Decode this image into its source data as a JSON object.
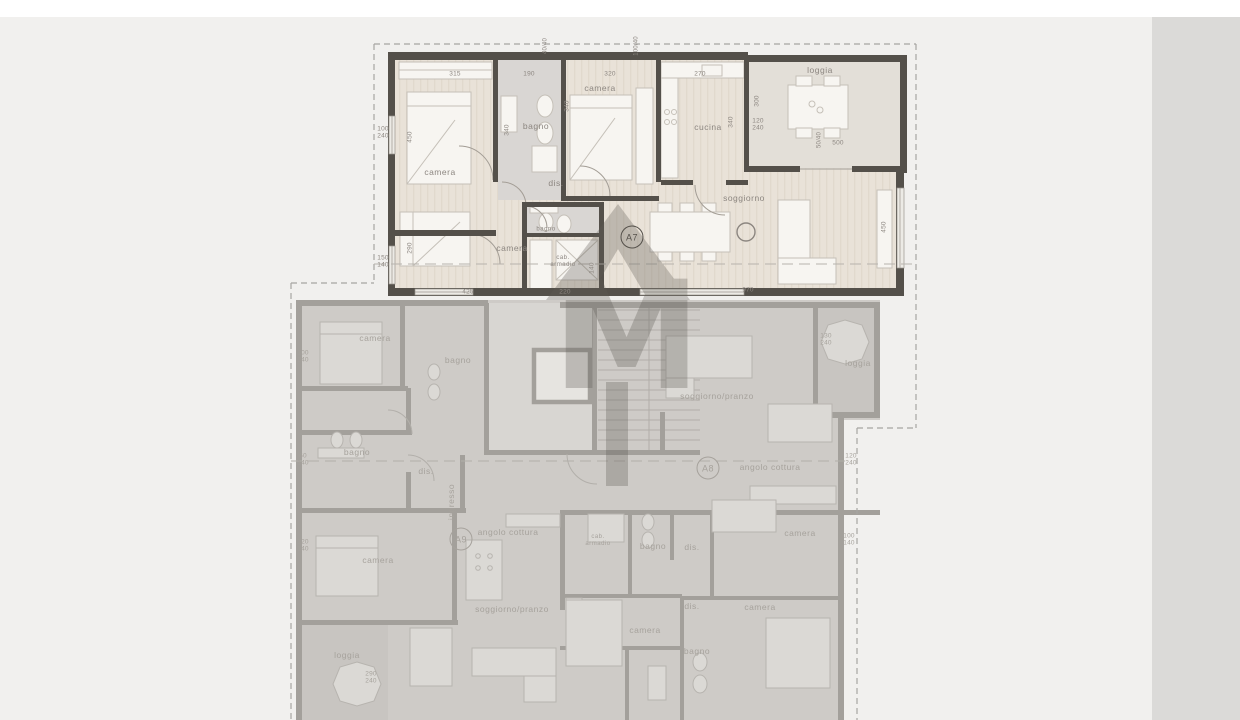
{
  "sidebar": {
    "floor_title": "PIANO SECONDO",
    "scale_label": "SCALA 1:100",
    "apartment_title": "APPARTAMENTO A7"
  },
  "watermark": {
    "letter": "M"
  },
  "apartment_a7": {
    "badges": [
      {
        "label": "A7",
        "x": 632,
        "y": 237
      }
    ],
    "room_labels": [
      {
        "label": "camera",
        "x": 440,
        "y": 173
      },
      {
        "label": "bagno",
        "x": 536,
        "y": 127
      },
      {
        "label": "camera",
        "x": 600,
        "y": 89
      },
      {
        "label": "cucina",
        "x": 708,
        "y": 128
      },
      {
        "label": "loggia",
        "x": 820,
        "y": 71
      },
      {
        "label": "dis.",
        "x": 556,
        "y": 184
      },
      {
        "label": "soggiorno",
        "x": 744,
        "y": 199
      },
      {
        "label": "camera",
        "x": 512,
        "y": 249
      },
      {
        "label": "bagno",
        "x": 546,
        "y": 230,
        "size": "s"
      },
      {
        "label": "cab.\narmadio",
        "x": 563,
        "y": 262,
        "size": "s"
      }
    ],
    "dim_labels": [
      {
        "text": "315",
        "x": 455,
        "y": 74
      },
      {
        "text": "190",
        "x": 529,
        "y": 74
      },
      {
        "text": "320",
        "x": 610,
        "y": 74
      },
      {
        "text": "270",
        "x": 700,
        "y": 74
      },
      {
        "text": "40/40",
        "x": 546,
        "y": 46,
        "rot": true,
        "size": "s"
      },
      {
        "text": "100/40",
        "x": 637,
        "y": 46,
        "rot": true,
        "size": "s"
      },
      {
        "text": "100\n240",
        "x": 383,
        "y": 133
      },
      {
        "text": "150\n140",
        "x": 383,
        "y": 262
      },
      {
        "text": "450",
        "x": 410,
        "y": 137,
        "rot": true
      },
      {
        "text": "290",
        "x": 410,
        "y": 248,
        "rot": true
      },
      {
        "text": "340",
        "x": 507,
        "y": 130,
        "rot": true
      },
      {
        "text": "340",
        "x": 567,
        "y": 106,
        "rot": true
      },
      {
        "text": "340",
        "x": 731,
        "y": 122,
        "rot": true
      },
      {
        "text": "300",
        "x": 757,
        "y": 101,
        "rot": true
      },
      {
        "text": "120\n240",
        "x": 758,
        "y": 125
      },
      {
        "text": "50/40",
        "x": 820,
        "y": 140,
        "rot": true,
        "size": "s"
      },
      {
        "text": "500",
        "x": 838,
        "y": 143
      },
      {
        "text": "450",
        "x": 884,
        "y": 227,
        "rot": true
      },
      {
        "text": "140",
        "x": 592,
        "y": 268,
        "rot": true
      },
      {
        "text": "425",
        "x": 468,
        "y": 292
      },
      {
        "text": "220",
        "x": 565,
        "y": 292
      },
      {
        "text": "970",
        "x": 748,
        "y": 290
      }
    ]
  },
  "floor_gray": {
    "badges": [
      {
        "label": "A8",
        "x": 708,
        "y": 468
      },
      {
        "label": "A9",
        "x": 461,
        "y": 539
      }
    ],
    "room_labels": [
      {
        "label": "camera",
        "x": 375,
        "y": 339
      },
      {
        "label": "bagno",
        "x": 458,
        "y": 361
      },
      {
        "label": "bagno",
        "x": 357,
        "y": 453
      },
      {
        "label": "dis.",
        "x": 426,
        "y": 472
      },
      {
        "label": "ingresso",
        "x": 452,
        "y": 502,
        "rot": true
      },
      {
        "label": "soggiorno/pranzo",
        "x": 717,
        "y": 397
      },
      {
        "label": "loggia",
        "x": 858,
        "y": 364
      },
      {
        "label": "angolo cottura",
        "x": 770,
        "y": 468
      },
      {
        "label": "angolo cottura",
        "x": 508,
        "y": 533
      },
      {
        "label": "camera",
        "x": 378,
        "y": 561
      },
      {
        "label": "soggiorno/pranzo",
        "x": 512,
        "y": 610
      },
      {
        "label": "loggia",
        "x": 347,
        "y": 656
      },
      {
        "label": "cab.\narmadio",
        "x": 598,
        "y": 541,
        "size": "s"
      },
      {
        "label": "bagno",
        "x": 653,
        "y": 547
      },
      {
        "label": "dis.",
        "x": 692,
        "y": 548
      },
      {
        "label": "camera",
        "x": 800,
        "y": 534
      },
      {
        "label": "dis.",
        "x": 692,
        "y": 607
      },
      {
        "label": "camera",
        "x": 760,
        "y": 608
      },
      {
        "label": "camera",
        "x": 645,
        "y": 631
      },
      {
        "label": "bagno",
        "x": 697,
        "y": 652
      }
    ],
    "dim_labels": [
      {
        "text": "100\n240",
        "x": 303,
        "y": 357
      },
      {
        "text": "60\n140",
        "x": 303,
        "y": 460
      },
      {
        "text": "120\n140",
        "x": 303,
        "y": 546
      },
      {
        "text": "290\n240",
        "x": 371,
        "y": 678
      },
      {
        "text": "130\n240",
        "x": 826,
        "y": 340
      },
      {
        "text": "120\n240",
        "x": 851,
        "y": 460
      },
      {
        "text": "100\n140",
        "x": 849,
        "y": 540
      }
    ]
  }
}
